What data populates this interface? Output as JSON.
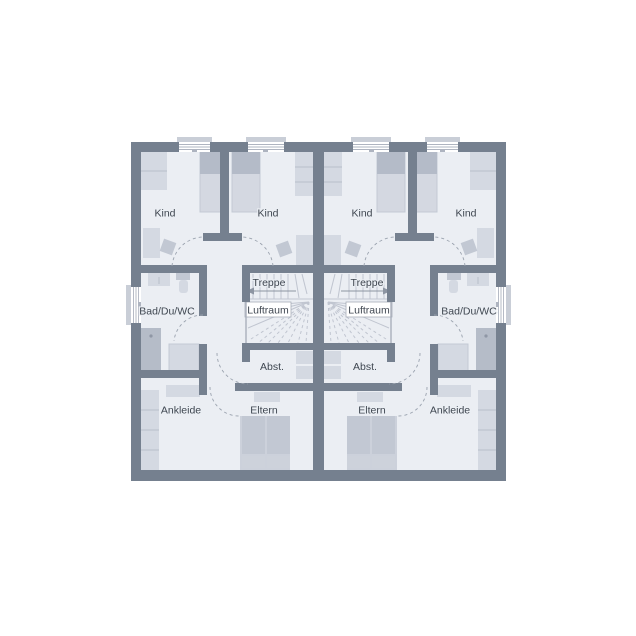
{
  "plan": {
    "rooms": {
      "kind": "Kind",
      "bath": "Bad/Du/WC",
      "stairs": "Treppe",
      "void": "Luftraum",
      "storage": "Abst.",
      "dressing": "Ankleide",
      "parents": "Eltern"
    },
    "colors": {
      "wall": "#75808f",
      "floor": "#ebeef3",
      "furniture_light": "#d4d9e2",
      "furniture_mid": "#c2c8d3",
      "furniture_dark": "#b5bcc8",
      "stair_line": "#c0c5d0",
      "door_arc": "#9aa2ae",
      "text": "#3f4650",
      "background": "#ffffff"
    }
  }
}
